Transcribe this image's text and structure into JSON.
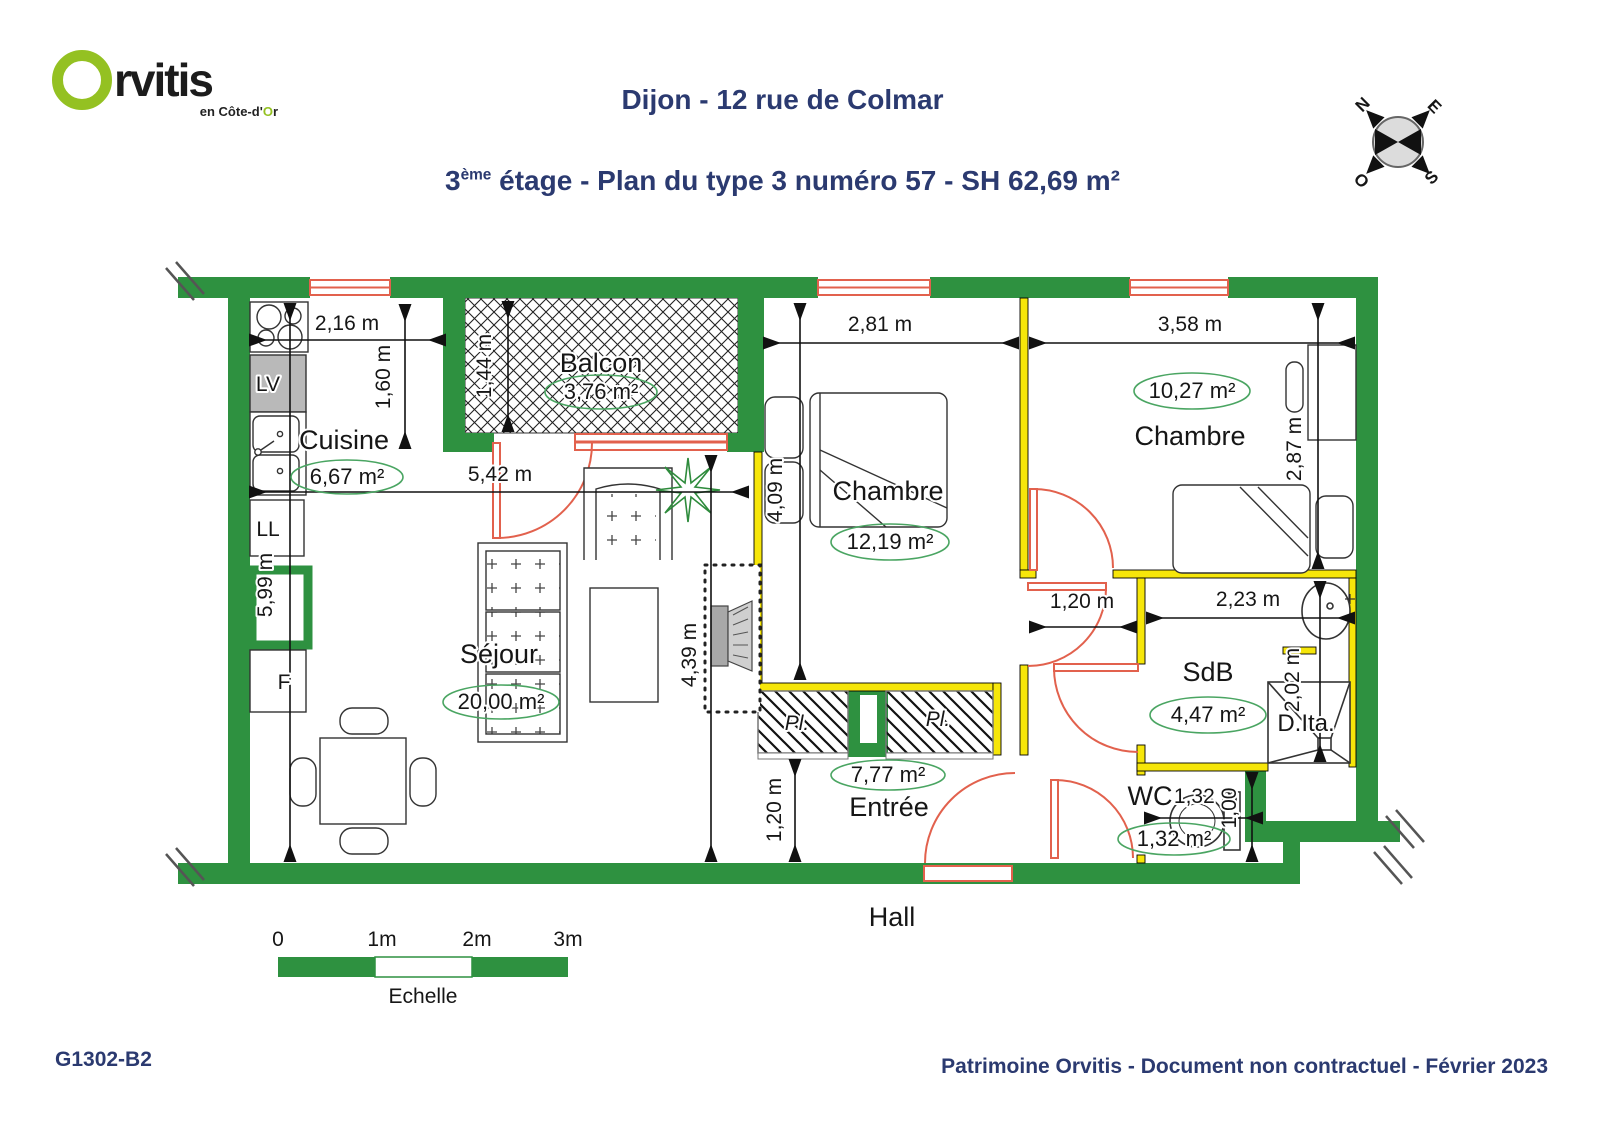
{
  "header": {
    "logo": {
      "brand_o": "O",
      "brand_rest": "rvitis",
      "tagline_pre": "en Côte-d'",
      "tagline_o": "O",
      "tagline_post": "r"
    },
    "title": "Dijon - 12 rue de Colmar",
    "subtitle": {
      "floor": "3",
      "sup": "ème",
      "rest": " étage - Plan du type 3 numéro 57 - SH 62,69 m²"
    }
  },
  "compass": {
    "n": "N",
    "e": "E",
    "s": "S",
    "o": "O"
  },
  "plan": {
    "rooms": {
      "balcon": {
        "name": "Balcon",
        "area": "3,76 m²"
      },
      "cuisine": {
        "name": "Cuisine",
        "area": "6,67 m²"
      },
      "sejour": {
        "name": "Séjour",
        "area": "20,00 m²"
      },
      "chambre1": {
        "name": "Chambre",
        "area": "12,19 m²"
      },
      "chambre2": {
        "name": "Chambre",
        "area": "10,27 m²"
      },
      "sdb": {
        "name": "SdB",
        "area": "4,47 m²"
      },
      "wc": {
        "name": "WC",
        "area": "1,32 m²"
      },
      "entree": {
        "name": "Entrée",
        "area": "7,77 m²"
      },
      "douche": {
        "name": "D.Ita."
      },
      "hall": {
        "name": "Hall"
      }
    },
    "labels": {
      "lv": "LV",
      "ll": "LL",
      "f": "F",
      "placard": "Pl."
    },
    "dims": {
      "k_w": "2,16 m",
      "k_d": "1,60 m",
      "left_h": "5,99 m",
      "balcon_d": "1,44 m",
      "sejour_w": "5,42 m",
      "sejour_h": "4,39 m",
      "ch1_w": "2,81 m",
      "ch1_h": "4,09 m",
      "ch2_w": "3,58 m",
      "ch2_h": "2,87 m",
      "corridor_w": "1,20 m",
      "sdb_w": "2,23 m",
      "sdb_h": "2,02 m",
      "entree_w": "1,20 m",
      "wc_w": "1,32 m",
      "wc_h": "1,00"
    }
  },
  "scalebar": {
    "t0": "0",
    "t1": "1m",
    "t2": "2m",
    "t3": "3m",
    "label": "Echelle"
  },
  "footer": {
    "ref": "G1302-B2",
    "note": "Patrimoine Orvitis - Document non contractuel - Février 2023"
  },
  "colors": {
    "wall_green": "#2e9140",
    "partition_yellow": "#f6e60a",
    "opening_red": "#e2614d",
    "area_ellipse_green": "#4aa562",
    "title_navy": "#2b3a70",
    "logo_green": "#94c122"
  }
}
